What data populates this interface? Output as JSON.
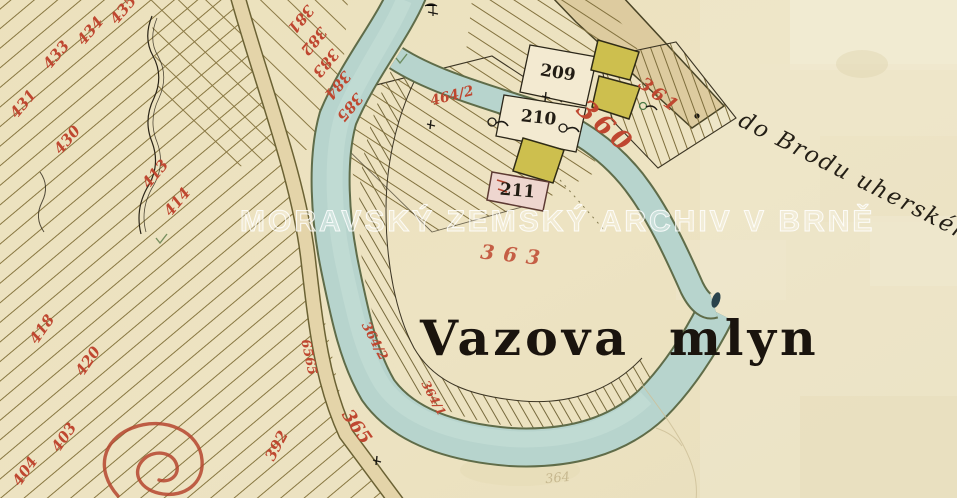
{
  "watermark": "MORAVSKÝ ZEMSKÝ ARCHIV V BRNĚ",
  "labels": {
    "place_title": "Vazova mlyn",
    "road_destination": "do Brodu uherského"
  },
  "parcels": {
    "black": {
      "p209": "209",
      "p210": "210",
      "p211": "211"
    },
    "red": {
      "r433": "433",
      "r434": "434",
      "r435": "435",
      "r431": "431",
      "r430": "430",
      "r413": "413",
      "r414": "414",
      "r381": "381",
      "r382": "382",
      "r383": "383",
      "r384": "384",
      "r385": "385",
      "r418": "418",
      "r420": "420",
      "r403": "403",
      "r404": "404",
      "r392": "392",
      "r6565": "6565",
      "r365": "365",
      "r364_2": "364/2",
      "r364_1": "364/1",
      "r363": "363",
      "r360": "360",
      "r361": "361",
      "r464_2": "464/2"
    },
    "pencil": {
      "p364": "364"
    }
  },
  "colors": {
    "parchment": "#ece2c0",
    "river": "#b7d4cd",
    "river_edge": "#5f6c49",
    "road": "#e4d4a9",
    "road_highway": "#ddcb9f",
    "building_yellow": "#cdbf4e",
    "building_pink": "#eed6cf",
    "label_red": "#bf4730",
    "ink": "#221d14"
  }
}
